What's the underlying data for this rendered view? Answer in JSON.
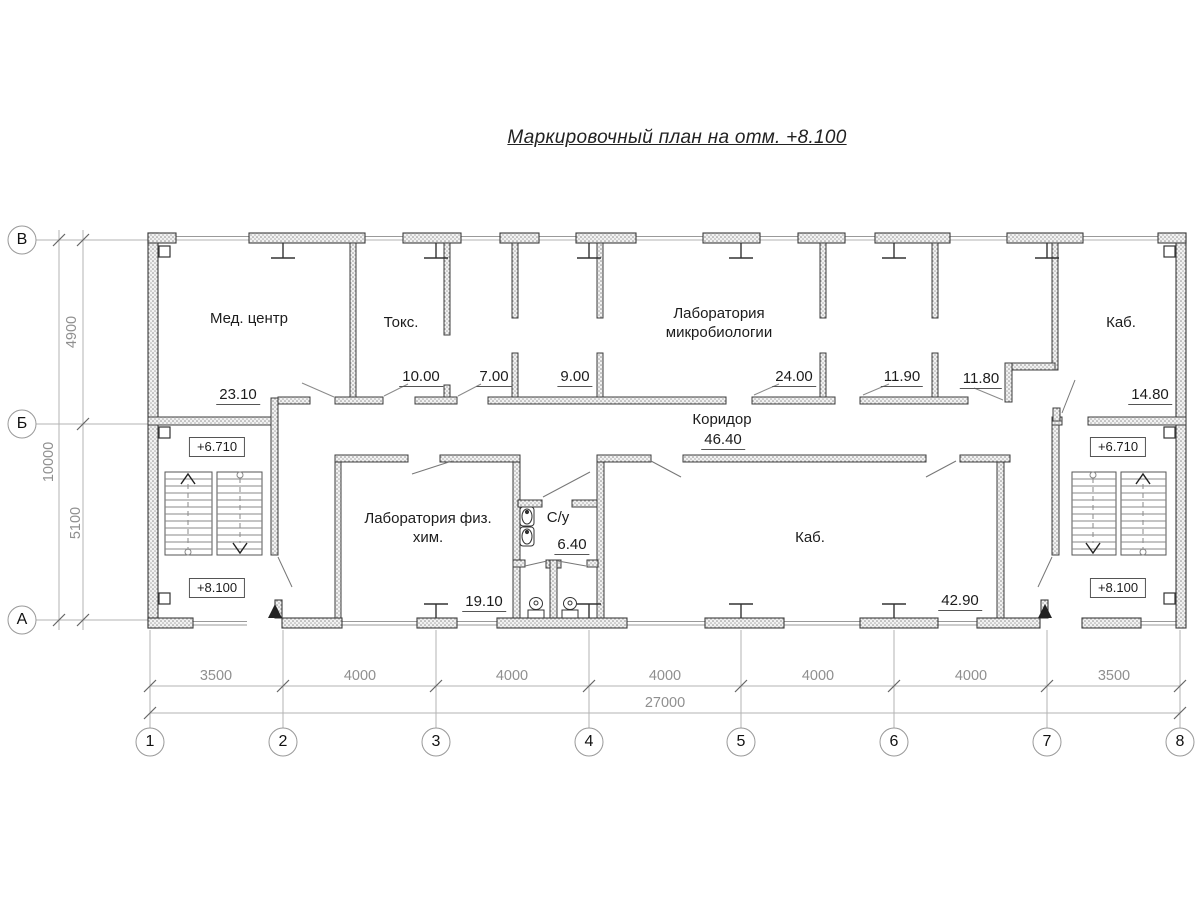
{
  "title": "Маркировочный план на отм. +8.100",
  "axes": {
    "vertical": [
      "В",
      "Б",
      "А"
    ],
    "horizontal": [
      "1",
      "2",
      "3",
      "4",
      "5",
      "6",
      "7",
      "8"
    ]
  },
  "dimensions": {
    "left_segments": [
      "4900",
      "5100"
    ],
    "left_total": "10000",
    "bottom_segments": [
      "3500",
      "4000",
      "4000",
      "4000",
      "4000",
      "4000",
      "3500"
    ],
    "bottom_total": "27000"
  },
  "rooms": {
    "med_center": {
      "name": "Мед. центр",
      "area": "23.10"
    },
    "toks": {
      "name": "Токс.",
      "area": "10.00"
    },
    "room7": {
      "area": "7.00"
    },
    "room9": {
      "area": "9.00"
    },
    "lab_micro": {
      "name": "Лаборатория микробиологии",
      "area": "24.00"
    },
    "room1190": {
      "area": "11.90"
    },
    "room1180": {
      "area": "11.80"
    },
    "kab_top": {
      "name": "Каб.",
      "area": "14.80"
    },
    "corridor": {
      "name": "Коридор",
      "area": "46.40"
    },
    "lab_fiz": {
      "name": "Лаборатория физ. хим.",
      "area": "19.10"
    },
    "su": {
      "name": "С/у",
      "area": "6.40"
    },
    "kab_bottom": {
      "name": "Каб.",
      "area": "42.90"
    }
  },
  "elevations": {
    "upper": "+6.710",
    "lower": "+8.100"
  }
}
